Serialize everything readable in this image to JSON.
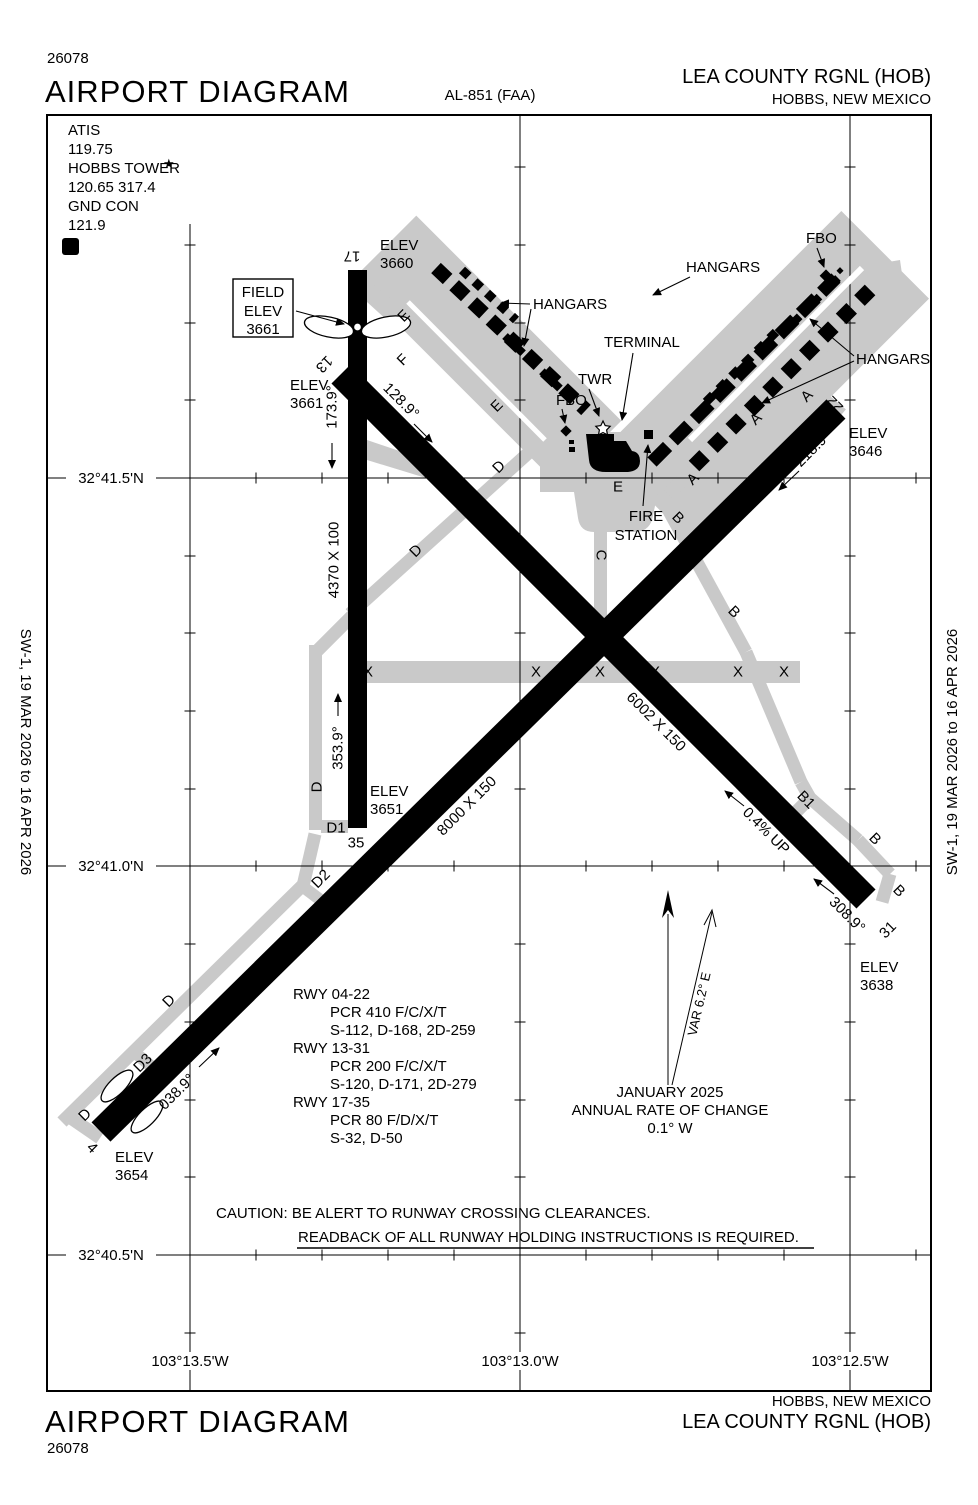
{
  "header": {
    "chart_number": "26078",
    "title": "AIRPORT DIAGRAM",
    "procedure_ref": "AL-851 (FAA)",
    "airport_name": "LEA COUNTY RGNL (HOB)",
    "city_state": "HOBBS, NEW MEXICO"
  },
  "footer": {
    "chart_number": "26078",
    "title": "AIRPORT DIAGRAM",
    "airport_name": "LEA COUNTY RGNL (HOB)",
    "city_state": "HOBBS, NEW MEXICO"
  },
  "edition": {
    "side_text": "SW-1,  19 MAR 2026  to  16 APR 2026"
  },
  "comms": {
    "atis_label": "ATIS",
    "atis_freq": "119.75",
    "tower_label": "HOBBS TOWER",
    "tower_star": "★",
    "tower_freqs": "120.65  317.4",
    "ground_label": "GND CON",
    "ground_freq": "121.9",
    "boxed_symbol": "D"
  },
  "grid": {
    "latitudes": [
      "32°41.5'N",
      "32°41.0'N",
      "32°40.5'N"
    ],
    "longitudes": [
      "103°13.5'W",
      "103°13.0'W",
      "103°12.5'W"
    ]
  },
  "field_elevation": {
    "line1": "FIELD",
    "line2": "ELEV",
    "line3": "3661"
  },
  "map": {
    "elev_label": "ELEV",
    "rwy_17_35": {
      "num_a": "17",
      "num_b": "35",
      "dim": "4370 X 100",
      "hdg_a": "173.9°",
      "hdg_b": "353.9°",
      "elev_a": "3660",
      "elev_b": "3651"
    },
    "rwy_13_31": {
      "num_a": "13",
      "num_b": "31",
      "dim": "6002 X 150",
      "hdg_a": "128.9°",
      "hdg_b": "308.9°",
      "elev_a": "3661",
      "elev_b": "3638",
      "gradient": "0.4% UP"
    },
    "rwy_04_22": {
      "num_a": "4",
      "num_b": "22",
      "dim": "8000 X 150",
      "hdg_a": "038.9°",
      "hdg_b": "218.9°",
      "elev_a": "3654",
      "elev_b": "3646"
    },
    "taxiways": {
      "A": "A",
      "B": "B",
      "B1": "B1",
      "C": "C",
      "D": "D",
      "D1": "D1",
      "D2": "D2",
      "D3": "D3",
      "E": "E",
      "F": "F",
      "X": "X"
    },
    "features": {
      "hangars": "HANGARS",
      "terminal": "TERMINAL",
      "tower": "TWR",
      "fbo": "FBO",
      "fire_line1": "FIRE",
      "fire_line2": "STATION"
    }
  },
  "variation": {
    "var_text": "VAR 6.2° E",
    "date": "JANUARY 2025",
    "rate_label": "ANNUAL RATE OF CHANGE",
    "rate_value": "0.1° W"
  },
  "runway_data": [
    {
      "runway": "RWY 04-22",
      "pcr": "PCR 410 F/C/X/T",
      "strengths": "S-112, D-168, 2D-259"
    },
    {
      "runway": "RWY 13-31",
      "pcr": "PCR 200 F/C/X/T",
      "strengths": "S-120, D-171, 2D-279"
    },
    {
      "runway": "RWY 17-35",
      "pcr": "PCR 80 F/D/X/T",
      "strengths": "S-32, D-50"
    }
  ],
  "caution": {
    "line1": "CAUTION: BE ALERT TO RUNWAY CROSSING CLEARANCES.",
    "line2": "READBACK OF ALL RUNWAY HOLDING INSTRUCTIONS IS REQUIRED."
  }
}
